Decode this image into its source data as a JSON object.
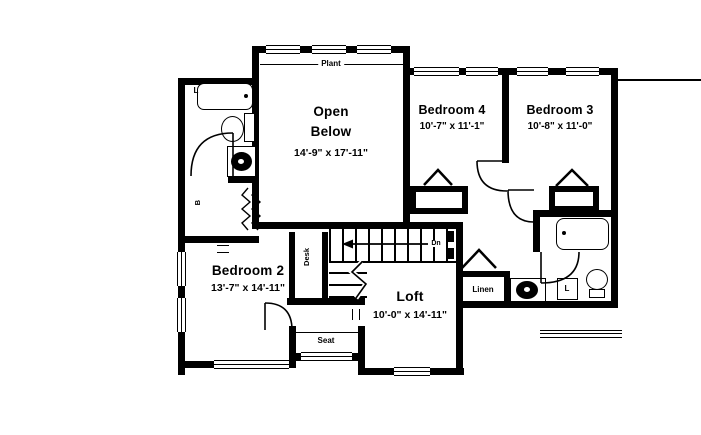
{
  "rooms": {
    "open_below": {
      "line1": "Open",
      "line2": "Below",
      "dims": "14'-9\" x 17'-11\""
    },
    "bedroom4": {
      "name": "Bedroom 4",
      "dims": "10'-7\" x 11'-1\""
    },
    "bedroom3": {
      "name": "Bedroom 3",
      "dims": "10'-8\" x 11'-0\""
    },
    "bedroom2": {
      "name": "Bedroom 2",
      "dims": "13'-7\" x 14'-11\""
    },
    "loft": {
      "name": "Loft",
      "dims": "10'-0\" x 14'-11\""
    }
  },
  "labels": {
    "plant": "Plant",
    "desk": "Desk",
    "seat": "Seat",
    "linen": "Linen",
    "down": "Dn",
    "linen_left": "L",
    "linen_right": "L",
    "closet_left": "B"
  },
  "colors": {
    "wall": "#000000",
    "background": "#ffffff"
  }
}
